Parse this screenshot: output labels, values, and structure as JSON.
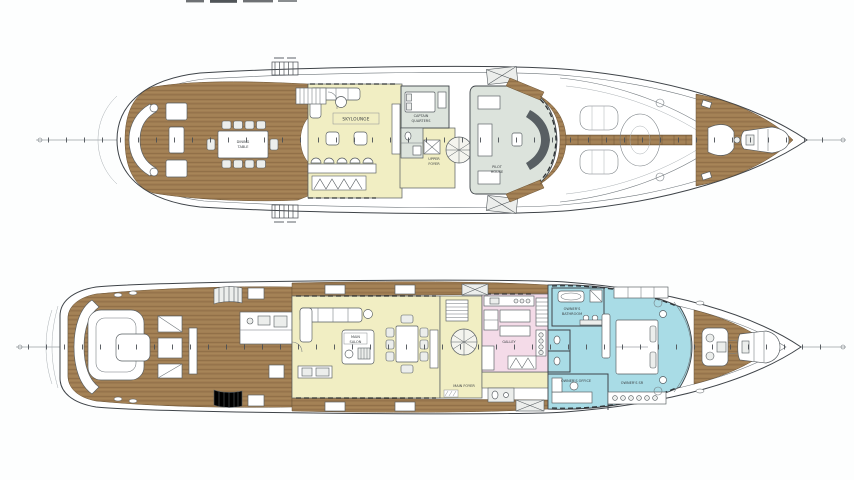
{
  "colors": {
    "wood": "#a17e53",
    "wood_line": "#8b6a43",
    "room_yellow": "#f1eec3",
    "room_pink": "#f4dbe8",
    "room_blue": "#a9dce6",
    "room_gray": "#dce3dc",
    "hull_line": "#3f4449",
    "detail_line": "#585f63",
    "white": "#ffffff"
  },
  "upper_deck": {
    "labels": {
      "dining_line1": "DINING",
      "dining_line2": "TABLE",
      "skylounge": "SKYLOUNGE",
      "captain_line1": "CAPTAIN",
      "captain_line2": "QUARTERS",
      "foyer_line1": "UPPER",
      "foyer_line2": "FOYER",
      "pilot_line1": "PILOT",
      "pilot_line2": "HOUSE"
    }
  },
  "main_deck": {
    "labels": {
      "salon_line1": "MAIN",
      "salon_line2": "SALON",
      "foyer": "MAIN FOYER",
      "galley": "GALLEY",
      "bath_line1": "OWNER'S",
      "bath_line2": "BATHROOM",
      "stateroom": "OWNER'S SR",
      "office": "OWNER'S OFFICE"
    }
  }
}
